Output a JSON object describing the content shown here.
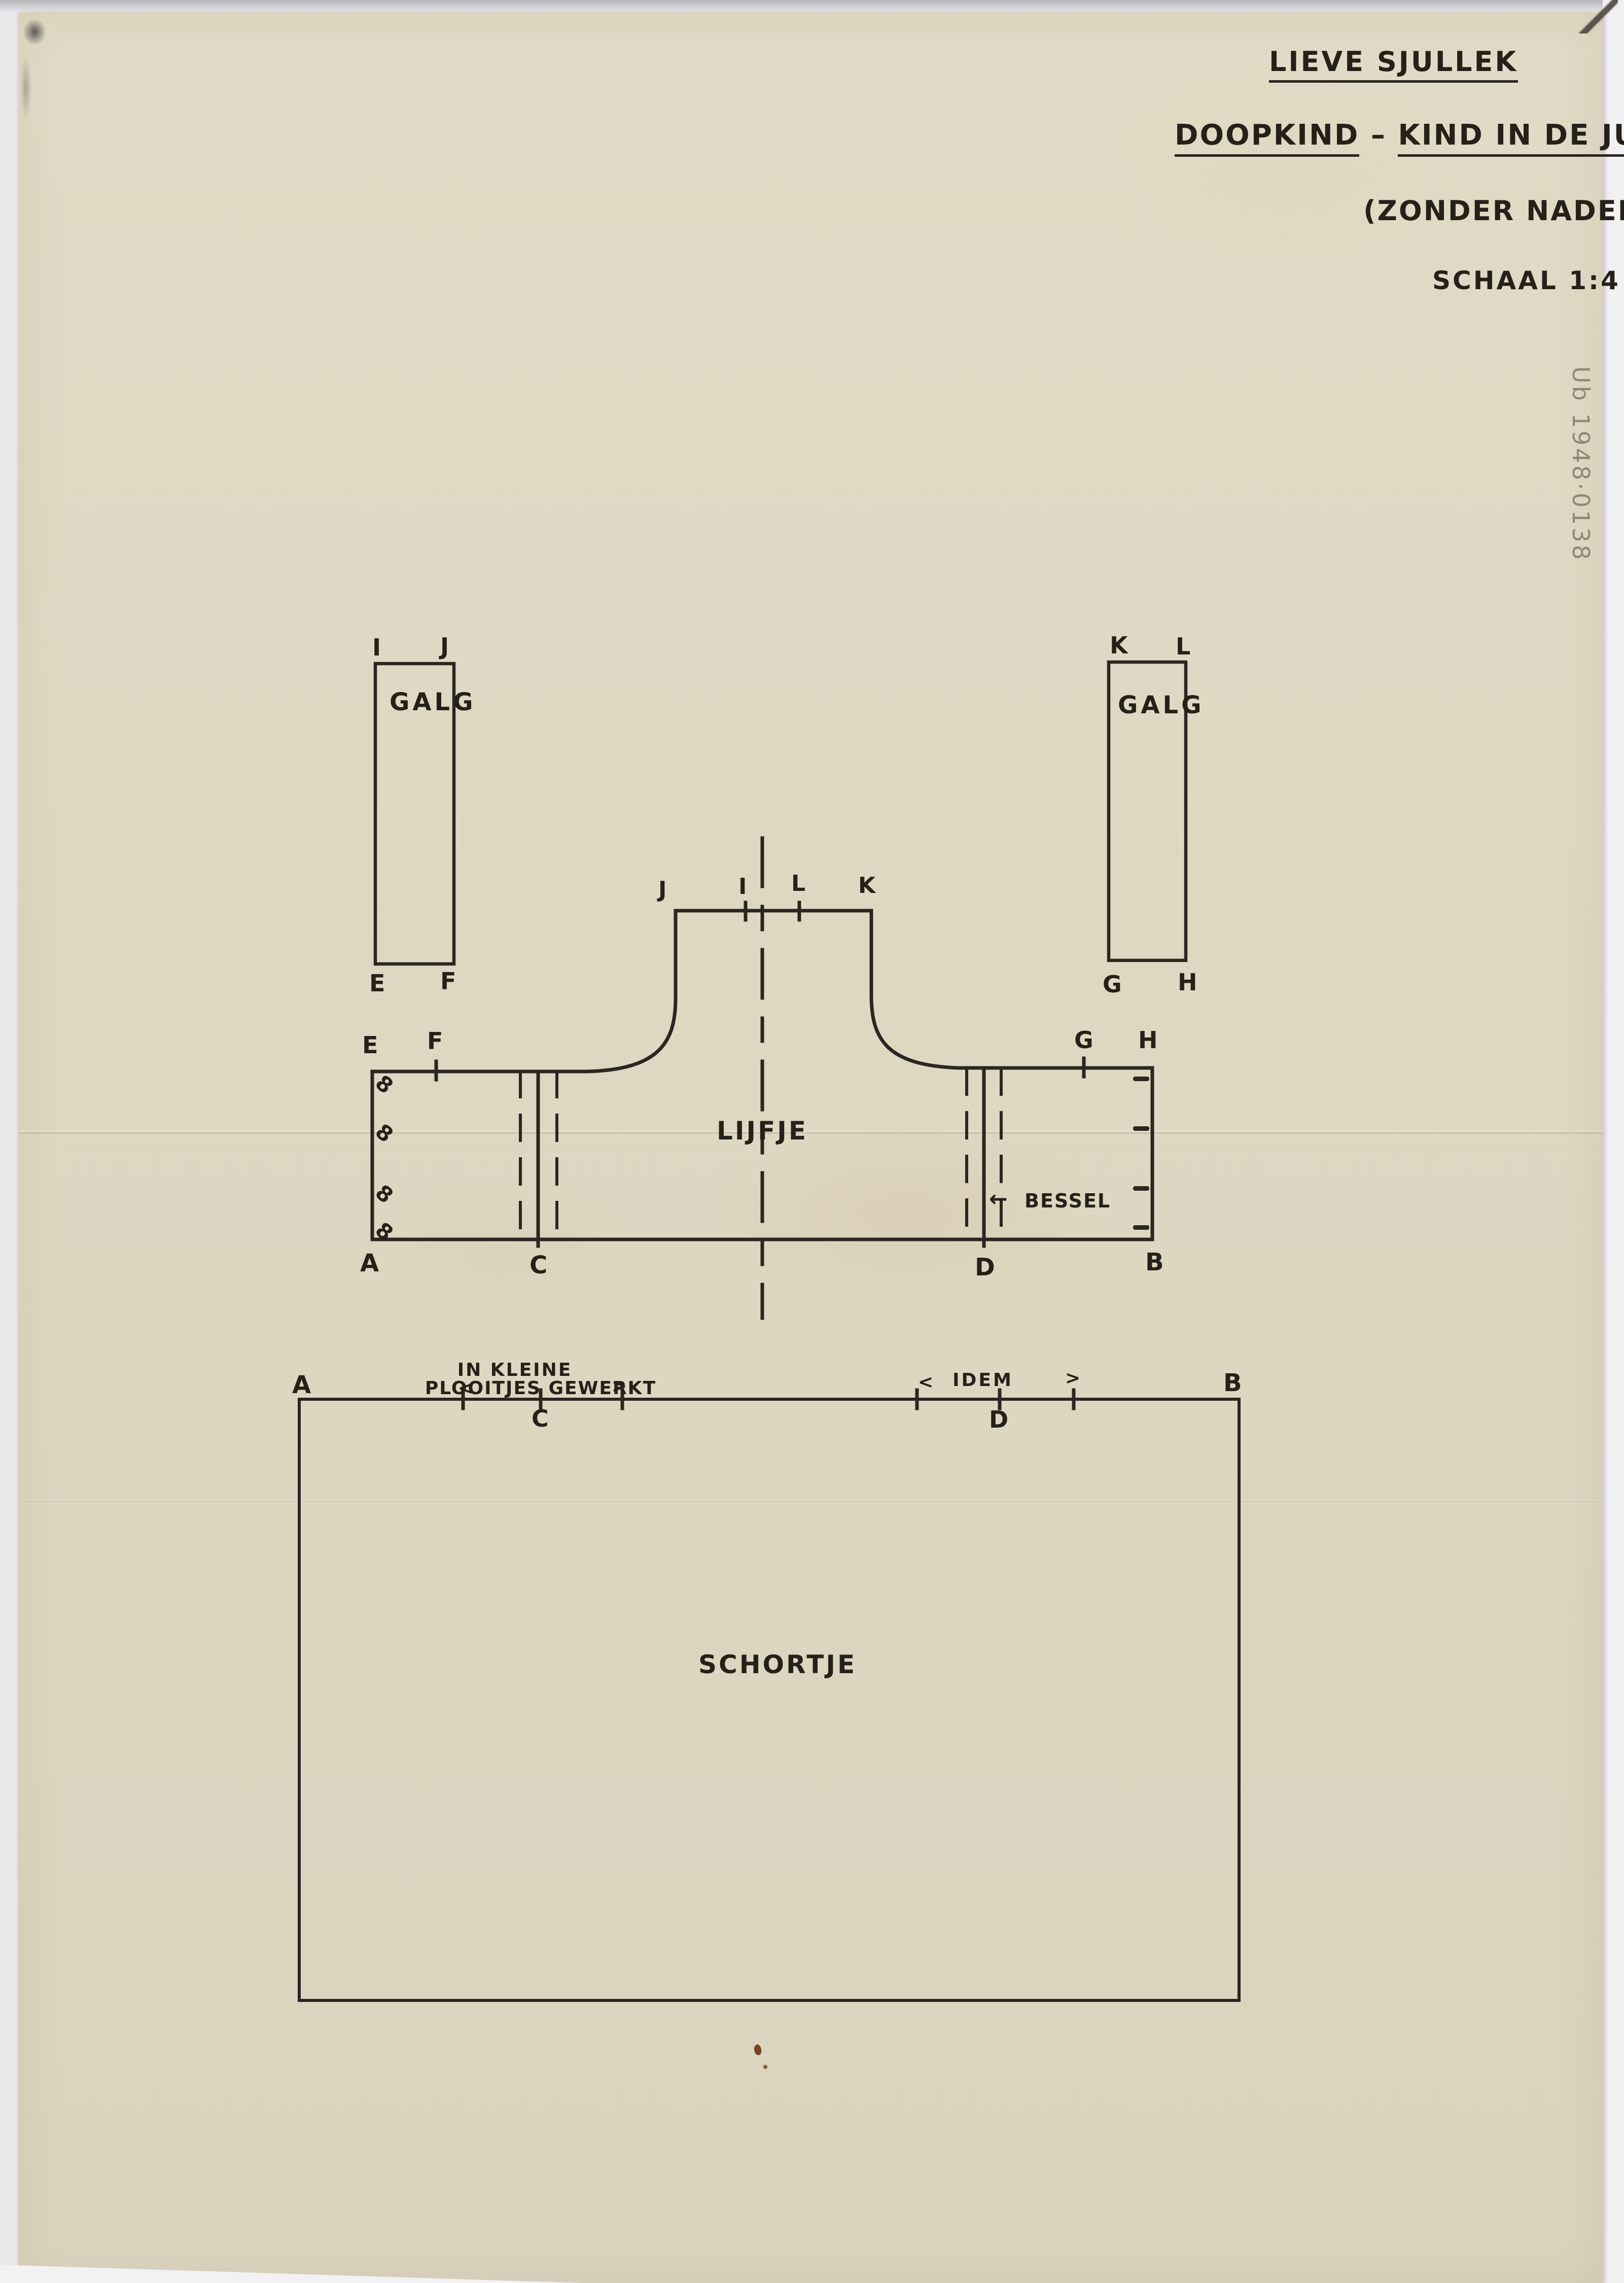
{
  "title_block": {
    "line1": "LIEVE SJULLEK",
    "line2_left": "DOOPKIND",
    "line2_dash": "–",
    "line2_right": "KIND IN DE JURK",
    "line3": "(ZONDER NADEN)",
    "line4": "SCHAAL 1:4"
  },
  "inventory_number": "Ub 1948·0138",
  "galg_left": {
    "label": "GALG",
    "top_left": "I",
    "top_right": "J",
    "bottom_left": "E",
    "bottom_right": "F"
  },
  "galg_right": {
    "label": "GALG",
    "top_left": "K",
    "top_right": "L",
    "bottom_left": "G",
    "bottom_right": "H"
  },
  "lijfje": {
    "label": "LIJFJE",
    "neck": {
      "far_left": "J",
      "mid_left": "I",
      "mid_right": "L",
      "far_right": "K"
    },
    "shoulder": {
      "left_outer": "E",
      "left_inner": "F",
      "right_inner": "G",
      "right_outer": "H"
    },
    "bottom": {
      "left": "A",
      "pleat_left": "C",
      "pleat_right": "D",
      "right": "B"
    },
    "annotation": {
      "arrow": "←",
      "label": "BESSEL"
    },
    "buttonhole_glyph": "8"
  },
  "schortje": {
    "label": "SCHORTJE",
    "top": {
      "left": "A",
      "pleat_left": "C",
      "pleat_right": "D",
      "right": "B"
    },
    "pleat_note_left": {
      "line1": "IN KLEINE",
      "open": "<",
      "line2": "PLOOITJES GEWERKT",
      "close": ">"
    },
    "pleat_note_right": {
      "open": "<",
      "label": "IDEM",
      "close": ">"
    }
  },
  "colors": {
    "paper": "#ded7c2",
    "ink": "#2b2620",
    "pencil": "#8e8878",
    "background": "#e9e9ec"
  }
}
